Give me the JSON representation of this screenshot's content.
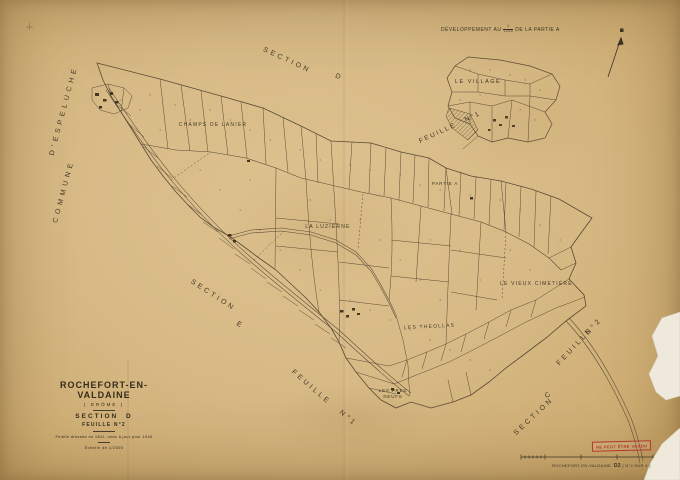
{
  "colors": {
    "paper": "#d7ba86",
    "ink": "#3d3323",
    "stamp_red": "#b5362a"
  },
  "top_note": {
    "prefix": "DÉVELOPPEMENT AU",
    "fraction_numerator": "1",
    "fraction_denominator": "1250",
    "suffix": "DE LA PARTIE A"
  },
  "inset": {
    "title": "LE VILLAGE",
    "sheet_word": "FEUILLE",
    "sheet_number": "N°1"
  },
  "edge_labels": {
    "commune_line1": "COMMUNE",
    "commune_line2": "D'ESPELUCHE",
    "section_d_word": "SECTION",
    "section_d_letter": "D",
    "section_e_word": "SECTION",
    "section_e_letter": "E",
    "feuille1_word": "FEUILLE",
    "feuille1_number": "N°1",
    "section_c_word": "SECTION",
    "section_c_letter": "C",
    "feuille2_word": "FEUILLE",
    "feuille2_number": "N°2"
  },
  "place_labels": {
    "champs_de_lanier": "CHAMPS DE LANIER",
    "la_luzierne": "LA LUZIERNE",
    "vieux_cimetiere": "LE VIEUX CIMETIÈRE",
    "les_theollas": "LES THEOLLAS",
    "les_pres_line1": "LES PRES",
    "les_pres_line2": "NEUFS",
    "partie_a": "PARTIE A"
  },
  "title_block": {
    "commune": "ROCHEFORT-EN-VALDAINE",
    "departement": "( DRÔME )",
    "section": "SECTION D",
    "sheet": "FEUILLE N°2",
    "revision": "Feuille dressée en 1811, mise à jour pour 1940",
    "scale": "Échelle de 1/2500"
  },
  "stamp": {
    "text": "NE PEUT ÊTRE VENDU"
  },
  "footer": {
    "reference": "ROCHEFORT-EN-VALDAINE.",
    "sheet_code": "D2",
    "suffix": "( N°2 SUR 4 )"
  }
}
